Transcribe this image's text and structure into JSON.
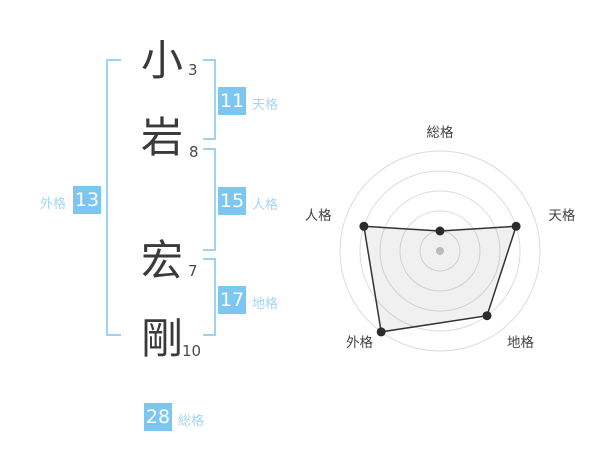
{
  "name_analysis": {
    "characters": [
      {
        "char": "小",
        "strokes": 3
      },
      {
        "char": "岩",
        "strokes": 8
      },
      {
        "char": "宏",
        "strokes": 7
      },
      {
        "char": "剛",
        "strokes": 10
      }
    ],
    "fortune": {
      "tenkaku": {
        "value": 11,
        "label": "天格"
      },
      "jinkaku": {
        "value": 15,
        "label": "人格"
      },
      "chikaku": {
        "value": 17,
        "label": "地格"
      },
      "gaikaku": {
        "value": 13,
        "label": "外格"
      },
      "soukaku": {
        "value": 28,
        "label": "総格"
      }
    }
  },
  "colors": {
    "badge_blue": "#7cc7f2",
    "label_blue": "#a5d6f3",
    "bracket_blue": "#9bd2f5",
    "text_dark": "#3a3a3a",
    "ring_gray": "#dcdcdc",
    "chart_label_gray": "#444444",
    "point_black": "#2b2b2b",
    "center_dot_gray": "#bbbbbb",
    "polygon_fill": "rgba(0,0,0,0.06)"
  },
  "chart_data": {
    "type": "radar",
    "categories": [
      "総格",
      "天格",
      "地格",
      "外格",
      "人格"
    ],
    "values": [
      1,
      4,
      4,
      5,
      4
    ],
    "max": 5,
    "rings": 5,
    "grid": "concentric-circles",
    "legend": "none",
    "start_axis": "top",
    "direction": "clockwise",
    "title": ""
  }
}
